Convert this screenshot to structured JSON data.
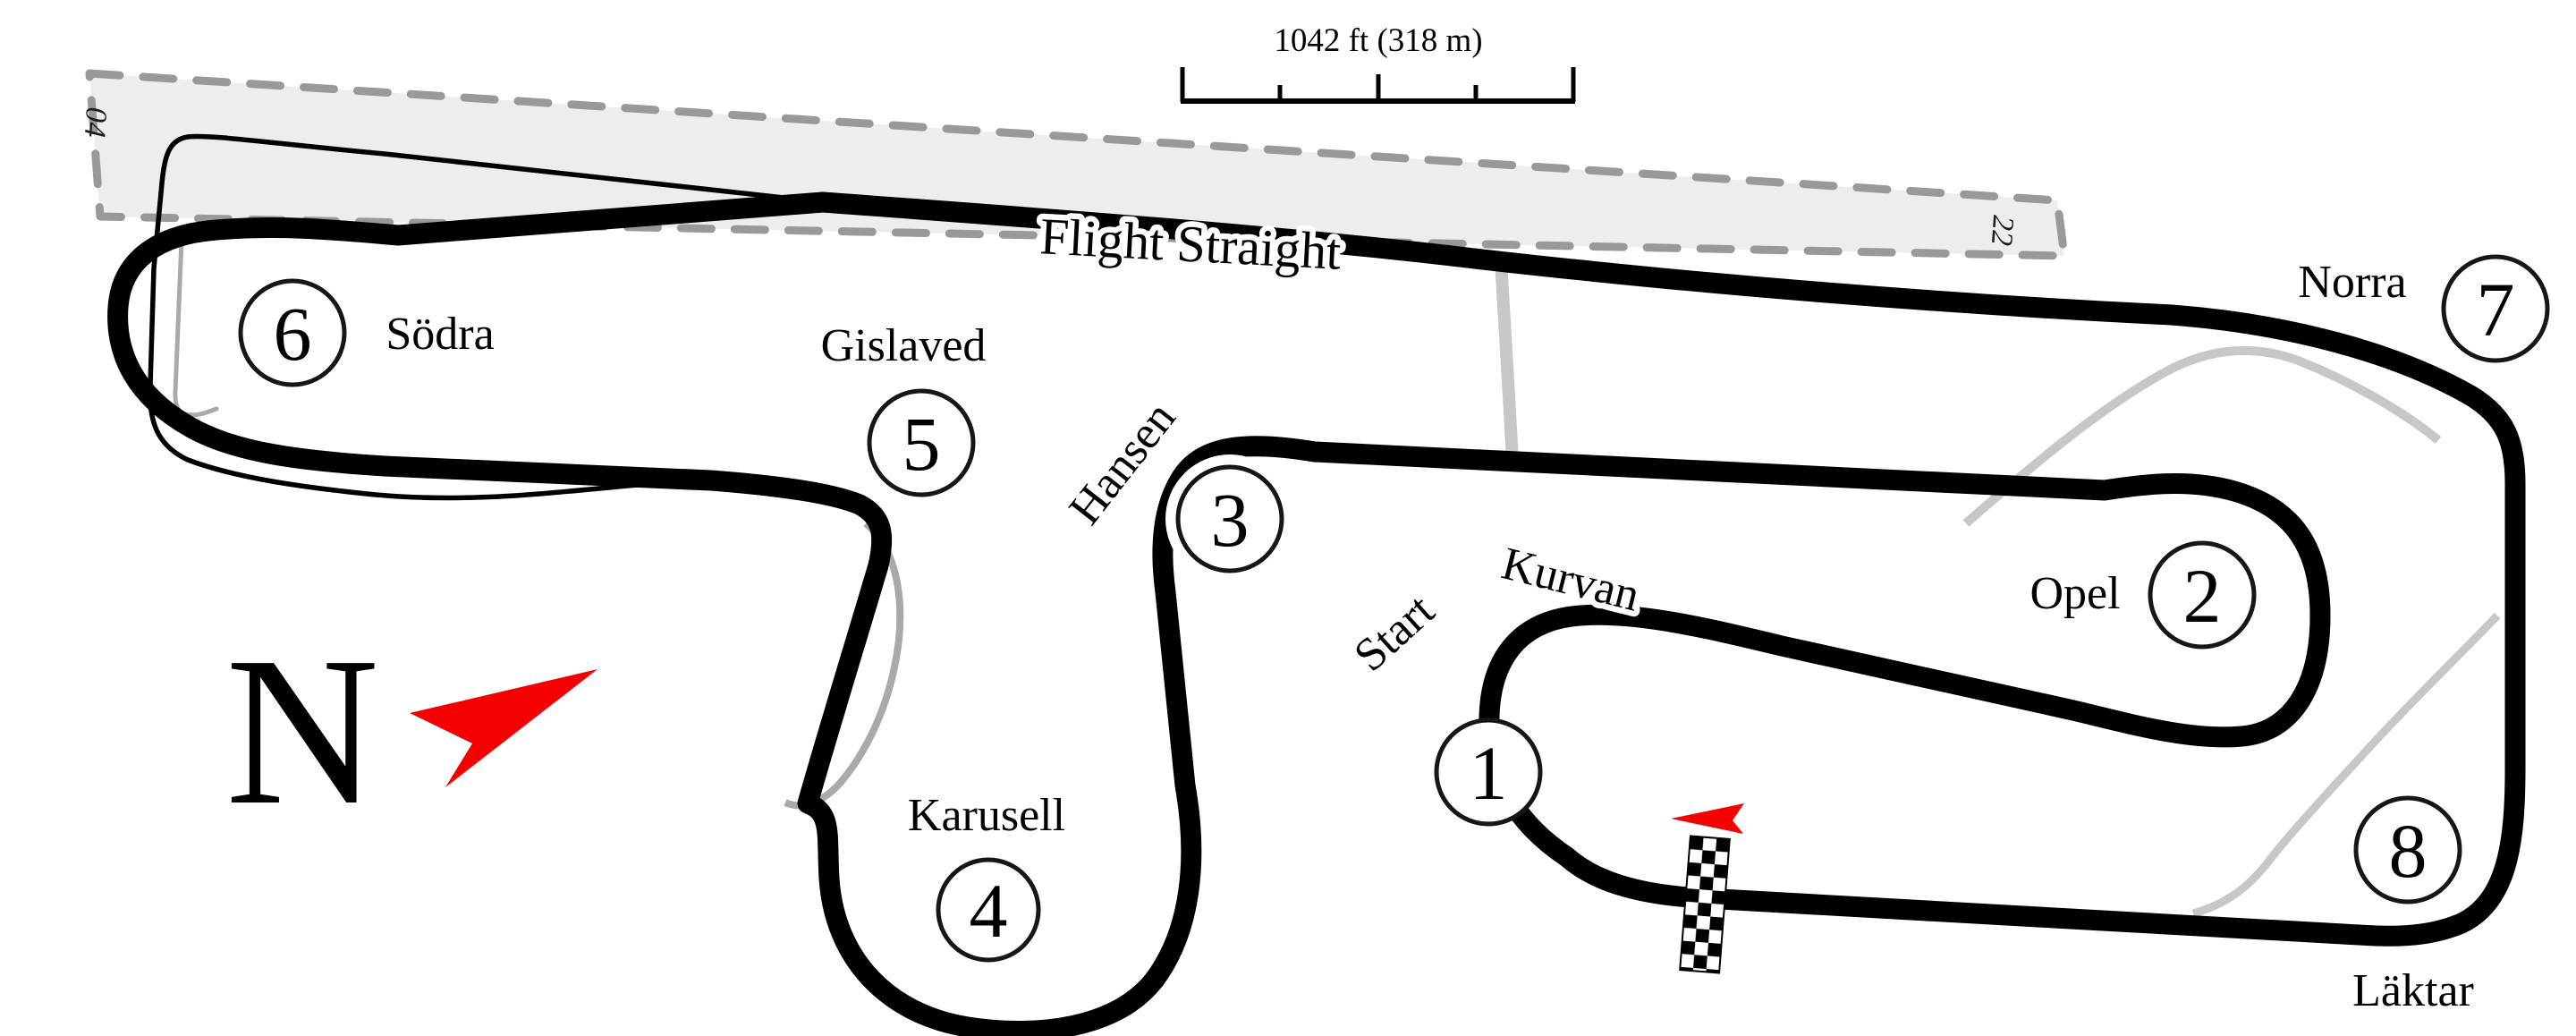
{
  "map": {
    "straight_label": "Flight Straight",
    "scale_bar": {
      "label": "1042 ft (318 m)"
    },
    "compass": {
      "letter": "N",
      "arrow_icon": "red-north-dart"
    },
    "runway": {
      "number_left": "04",
      "number_right": "22"
    },
    "turns": [
      {
        "number": "1",
        "name": "Start Kurvan",
        "name_words": [
          "Start",
          "Kurvan"
        ]
      },
      {
        "number": "2",
        "name": "Opel"
      },
      {
        "number": "3",
        "name": "Hansen"
      },
      {
        "number": "4",
        "name": "Karusell"
      },
      {
        "number": "5",
        "name": "Gislaved"
      },
      {
        "number": "6",
        "name": "Södra"
      },
      {
        "number": "7",
        "name": "Norra"
      },
      {
        "number": "8",
        "name": "Läktar"
      }
    ],
    "start_finish": {
      "flag_icon": "red-direction-flag",
      "line_icon": "checkered-finish-line"
    },
    "colors": {
      "track": "#000000",
      "label": "#000000",
      "runway_fill": "#ededed",
      "runway_dash": "#999999",
      "service_road": "#c7c7c7",
      "pit_lane": "#a9a9a9",
      "accent_red": "#f40000"
    }
  }
}
